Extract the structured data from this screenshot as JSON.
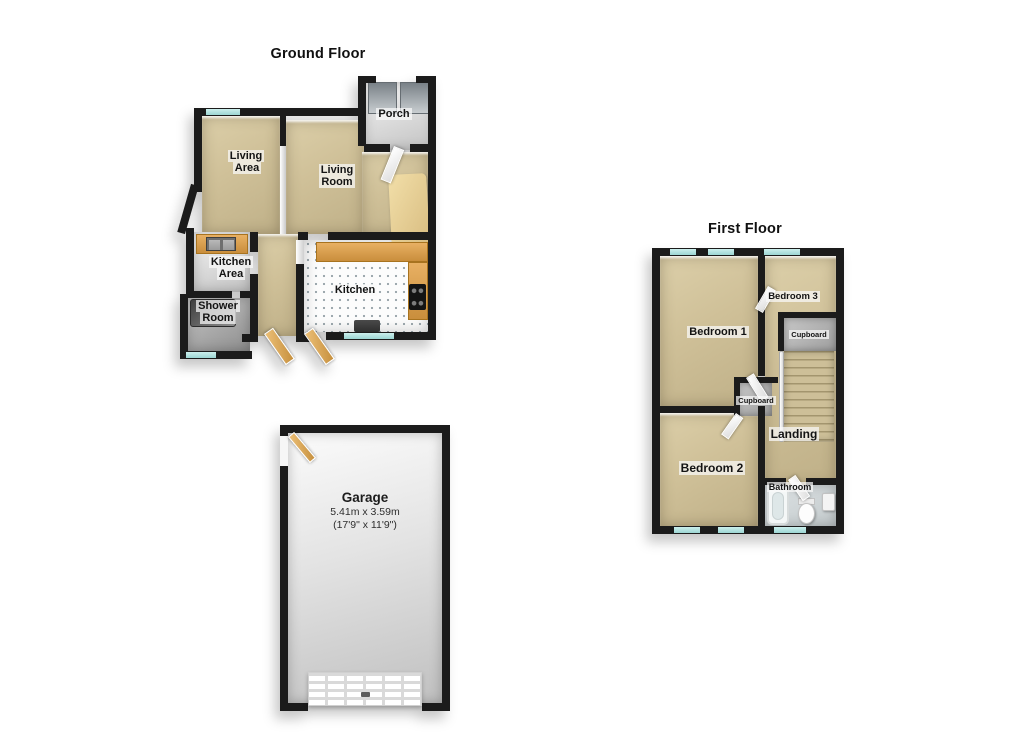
{
  "ground_floor": {
    "title": "Ground Floor",
    "rooms": {
      "porch": "Porch",
      "living_area": "Living Area",
      "living_room": "Living Room",
      "kitchen_area": "Kitchen Area",
      "shower_room": "Shower Room",
      "kitchen": "Kitchen"
    }
  },
  "first_floor": {
    "title": "First Floor",
    "rooms": {
      "bedroom1": "Bedroom 1",
      "bedroom2": "Bedroom 2",
      "bedroom3": "Bedroom 3",
      "cupboard_upper": "Cupboard",
      "cupboard_lower": "Cupboard",
      "landing": "Landing",
      "bathroom": "Bathroom"
    }
  },
  "garage": {
    "name": "Garage",
    "size_metric": "5.41m x 3.59m",
    "size_imperial": "(17'9\" x 11'9\")"
  },
  "colors": {
    "wall": "#1b1b1b",
    "floor_tan": "#cfc098",
    "wood_accent": "#d89a4a",
    "window_glass": "#9cd6d3",
    "kitchen_floor": "#fcfcfc"
  }
}
